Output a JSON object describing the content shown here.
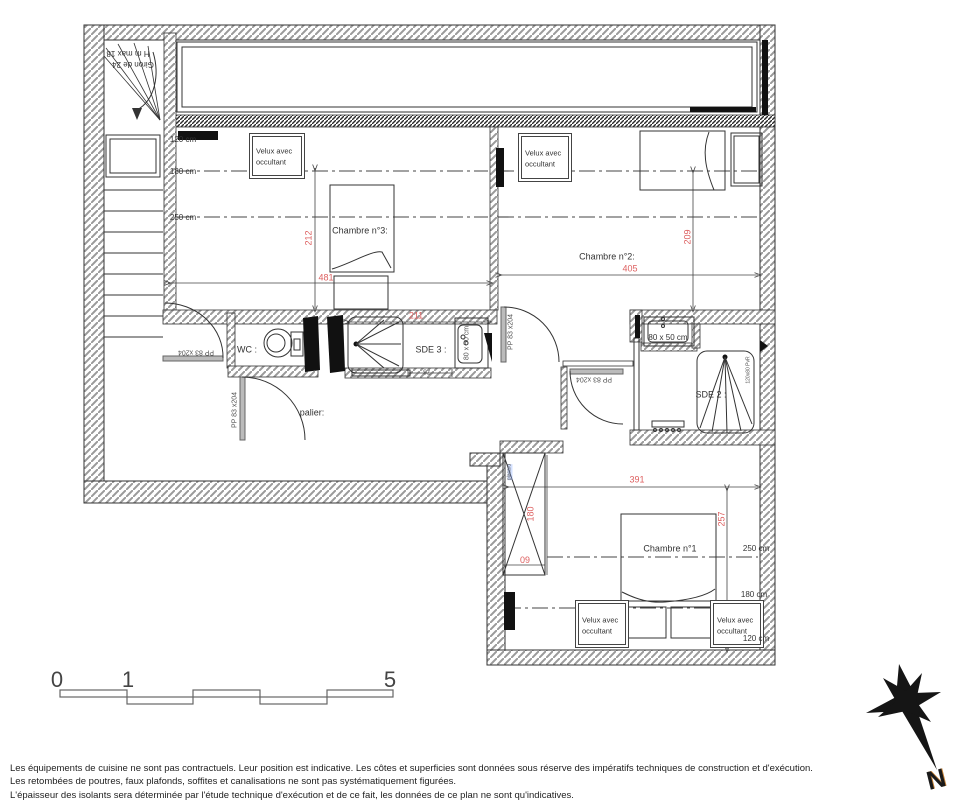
{
  "labels": {
    "room_ch3": "Chambre n°3:",
    "room_ch2": "Chambre n°2:",
    "room_ch1": "Chambre n°1",
    "wc": "WC :",
    "sde3": "SDE 3 :",
    "sde2": "SDE 2 :",
    "palier": "palier:",
    "velux_l1": "Velux avec",
    "velux_l2": "occultant",
    "door_pp": "PP 83 x204",
    "stair_l1": "Giron de 24",
    "stair_l2": "H m max 18",
    "shaft": "placard"
  },
  "heights": {
    "left": [
      "120 cm",
      "180 cm",
      "250 cm"
    ],
    "right": [
      "250 cm",
      "180 cm",
      "120 cm"
    ]
  },
  "dims": {
    "ch3_w": "481",
    "ch3_h": "212",
    "ch2_w": "405",
    "ch2_h": "209",
    "ch1_w": "391",
    "ch1_h": "257",
    "sde3_w": "211",
    "shower_gap": "73",
    "wardrobe_h": "180",
    "wardrobe_d": "60"
  },
  "fixtures": {
    "sink_sde3": "80 x 50 cm",
    "sink_sde2": "80 x 50 cm",
    "shower_sde2": "120x80 PvR"
  },
  "scale": {
    "t0": "0",
    "t1": "1",
    "t5": "5"
  },
  "compass": {
    "n": "N"
  },
  "colors": {
    "dim_red": "#dd5f5f",
    "wall_line": "#333333"
  },
  "footer": {
    "line1": "Les équipements de cuisine ne sont pas contractuels. Leur position est indicative. Les côtes et superficies sont données sous réserve des impératifs techniques de construction et d'exécution.",
    "line2": "Les retombées de poutres, faux plafonds, soffites et canalisations ne sont pas systématiquement figurées.",
    "line3": "L'épaisseur des isolants sera déterminée par l'étude technique d'exécution et de ce fait, les données de ce plan ne sont qu'indicatives."
  }
}
